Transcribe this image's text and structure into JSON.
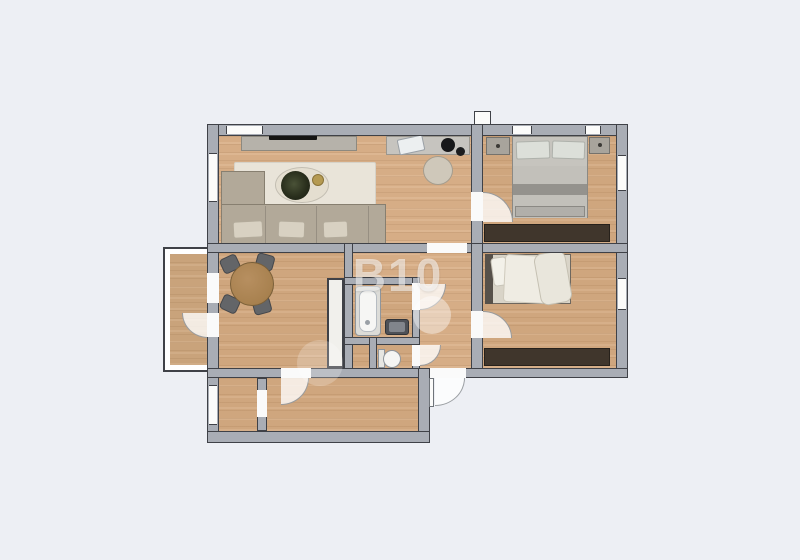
{
  "watermark": {
    "text": "B10",
    "color": "#ffffff",
    "opacity": 0.55
  },
  "palette": {
    "background": "#edeff4",
    "wall_fill": "#a9adb5",
    "wall_line": "#3f4147",
    "floor_wood_light": "#dab089",
    "floor_wood_mid": "#d3a980",
    "wardrobe_dark": "#40362c",
    "rug_cream": "#e9e4d9",
    "sofa_gray_beige": "#b2a999",
    "table_wood": "#b78f60",
    "chair_dark_gray": "#636568",
    "fixture_white": "#f5f5f3",
    "window_white": "#fbfbfa"
  },
  "plan": {
    "rooms": [
      "living-room",
      "bedroom-1",
      "bedroom-2",
      "dining-room",
      "bathroom",
      "wc",
      "hallway",
      "corridor",
      "storage-room",
      "balcony"
    ],
    "furniture": [
      "tv-sideboard",
      "desk",
      "desk-chair",
      "corner-sofa",
      "rug",
      "coffee-table-plant",
      "double-bed",
      "nightstands",
      "wardrobes",
      "single-bed",
      "dining-table",
      "dining-chairs",
      "tall-cabinet",
      "bathtub",
      "sink",
      "toilet"
    ]
  }
}
